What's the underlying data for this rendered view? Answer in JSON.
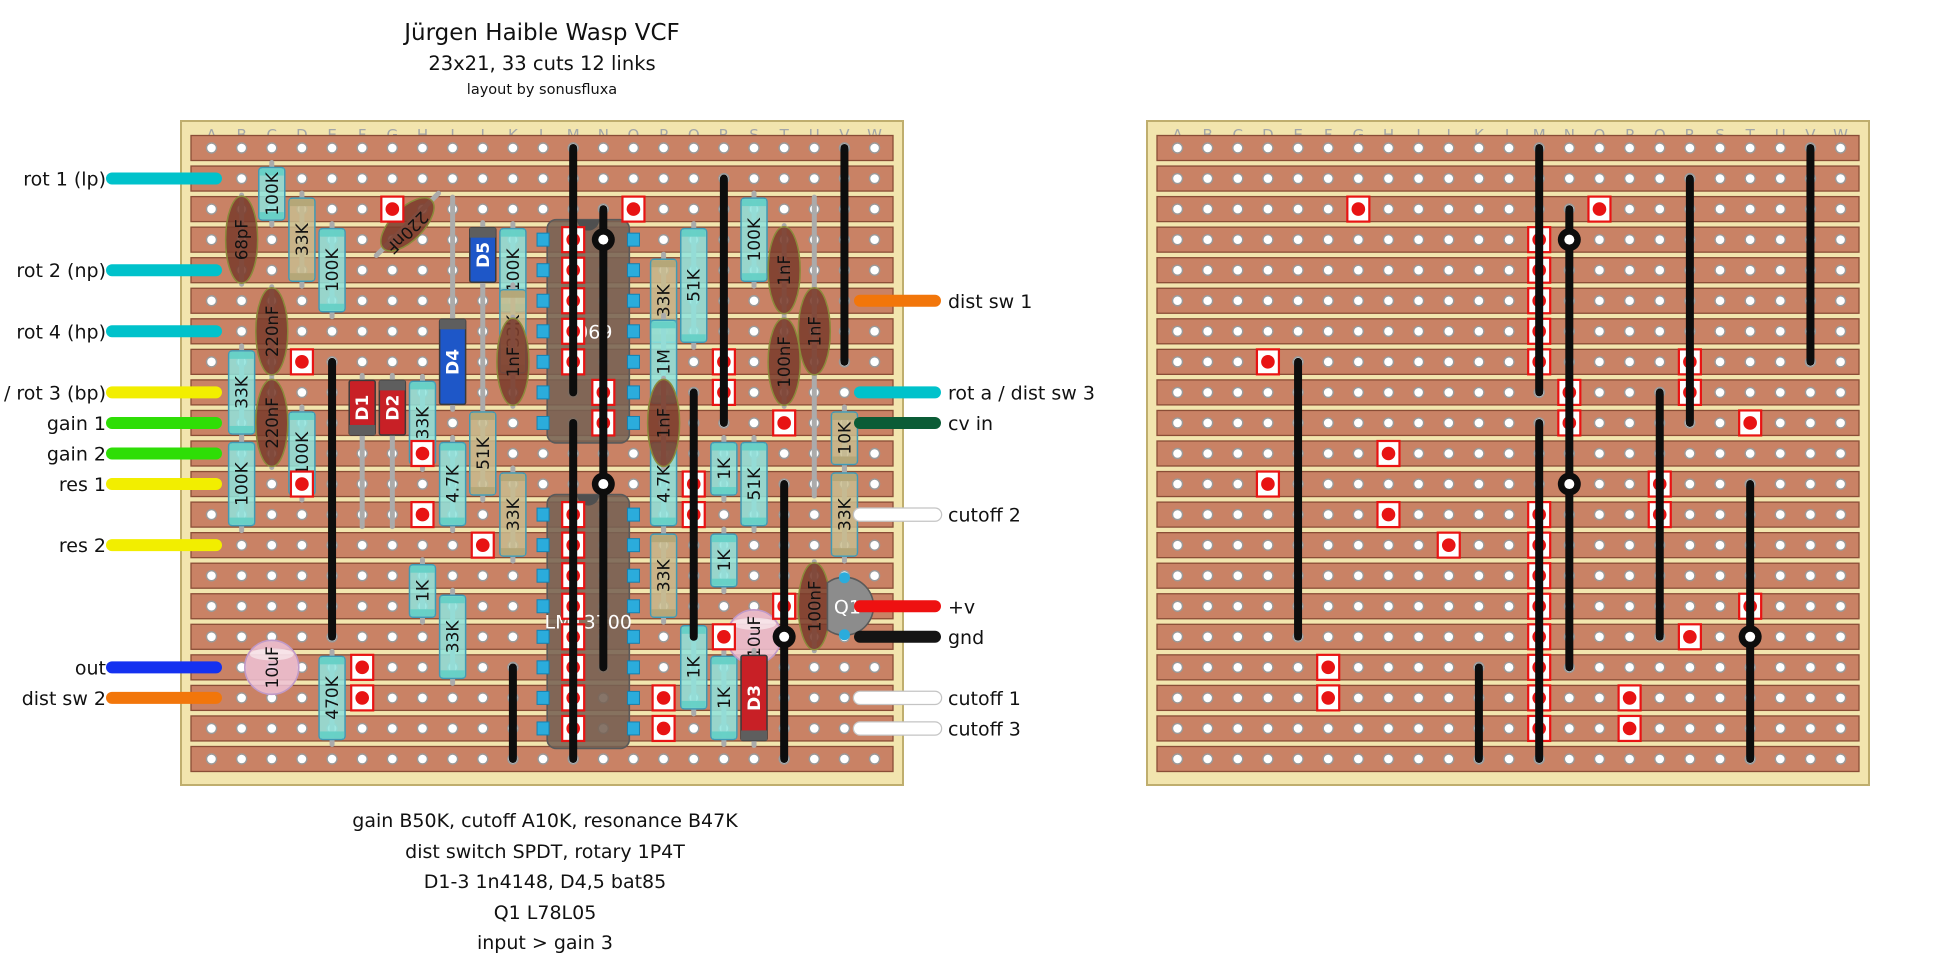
{
  "title": {
    "main": "Jürgen Haible Wasp VCF",
    "sub": "23x21, 33 cuts 12 links",
    "credit": "layout by sonusfluxa"
  },
  "notes": [
    "gain B50K, cutoff A10K, resonance B47K",
    "dist switch SPDT, rotary 1P4T",
    "D1-3 1n4148, D4,5 bat85",
    "Q1 L78L05",
    "input > gain 3"
  ],
  "grid": {
    "cols": "ABCDEFGHIJKLMNOPQRSTUVW",
    "rows": "ABCDEFGHIJKLMNOPQRSTU"
  },
  "cuts": [
    [
      "G",
      "C"
    ],
    [
      "O",
      "C"
    ],
    [
      "M",
      "D"
    ],
    [
      "M",
      "E"
    ],
    [
      "M",
      "F"
    ],
    [
      "M",
      "G"
    ],
    [
      "M",
      "H"
    ],
    [
      "D",
      "H"
    ],
    [
      "R",
      "H"
    ],
    [
      "N",
      "I"
    ],
    [
      "R",
      "I"
    ],
    [
      "N",
      "J"
    ],
    [
      "T",
      "J"
    ],
    [
      "H",
      "K"
    ],
    [
      "D",
      "L"
    ],
    [
      "Q",
      "L"
    ],
    [
      "H",
      "M"
    ],
    [
      "M",
      "M"
    ],
    [
      "Q",
      "M"
    ],
    [
      "J",
      "N"
    ],
    [
      "M",
      "N"
    ],
    [
      "M",
      "O"
    ],
    [
      "M",
      "P"
    ],
    [
      "T",
      "P"
    ],
    [
      "M",
      "Q"
    ],
    [
      "R",
      "Q"
    ],
    [
      "F",
      "R"
    ],
    [
      "M",
      "R"
    ],
    [
      "F",
      "S"
    ],
    [
      "M",
      "S"
    ],
    [
      "P",
      "S"
    ],
    [
      "M",
      "T"
    ],
    [
      "P",
      "T"
    ]
  ],
  "links": [
    [
      "M",
      "A",
      "I"
    ],
    [
      "M",
      "J",
      "U"
    ],
    [
      "V",
      "A",
      "H"
    ],
    [
      "R",
      "B",
      "J"
    ],
    [
      "N",
      "C",
      "D"
    ],
    [
      "N",
      "D",
      "L"
    ],
    [
      "N",
      "L",
      "R"
    ],
    [
      "E",
      "H",
      "Q"
    ],
    [
      "Q",
      "I",
      "Q"
    ],
    [
      "T",
      "L",
      "Q"
    ],
    [
      "T",
      "Q",
      "U"
    ],
    [
      "K",
      "R",
      "U"
    ]
  ],
  "junctions": [
    [
      "N",
      "D"
    ],
    [
      "N",
      "L"
    ],
    [
      "T",
      "Q"
    ]
  ],
  "ics": [
    {
      "label": "4069",
      "row1": "D",
      "row2": "J"
    },
    {
      "label": "LM13700",
      "row1": "M",
      "row2": "T"
    }
  ],
  "transistor": {
    "label": "Q1",
    "col": "V",
    "row1": "O",
    "row2": "Q"
  },
  "resistors": [
    {
      "label": "100K",
      "col": "C",
      "row1": "B",
      "row2": "C",
      "style": "cyan"
    },
    {
      "label": "33K",
      "col": "D",
      "row1": "C",
      "row2": "E",
      "style": "tan"
    },
    {
      "label": "100K",
      "col": "E",
      "row1": "D",
      "row2": "F",
      "style": "cyan"
    },
    {
      "label": "100K",
      "col": "K",
      "row1": "D",
      "row2": "F",
      "style": "cyan"
    },
    {
      "label": "100K",
      "col": "S",
      "row1": "C",
      "row2": "E",
      "style": "cyan"
    },
    {
      "label": "51K",
      "col": "Q",
      "row1": "D",
      "row2": "G",
      "style": "cyan"
    },
    {
      "label": "33K",
      "col": "P",
      "row1": "E",
      "row2": "G",
      "style": "tan"
    },
    {
      "label": "33K",
      "col": "K",
      "row1": "F",
      "row2": "H",
      "style": "tan"
    },
    {
      "label": "1M",
      "col": "P",
      "row1": "G",
      "row2": "I",
      "style": "cyan"
    },
    {
      "label": "33K",
      "col": "B",
      "row1": "H",
      "row2": "J",
      "style": "cyan"
    },
    {
      "label": "33K",
      "col": "H",
      "row1": "I",
      "row2": "K",
      "style": "cyan"
    },
    {
      "label": "51K",
      "col": "J",
      "row1": "J",
      "row2": "L",
      "style": "tan"
    },
    {
      "label": "100K",
      "col": "D",
      "row1": "J",
      "row2": "L",
      "style": "cyan"
    },
    {
      "label": "10K",
      "col": "V",
      "row1": "J",
      "row2": "K",
      "style": "tan"
    },
    {
      "label": "100K",
      "col": "B",
      "row1": "K",
      "row2": "M",
      "style": "cyan"
    },
    {
      "label": "4.7K",
      "col": "I",
      "row1": "K",
      "row2": "M",
      "style": "cyan"
    },
    {
      "label": "1K",
      "col": "R",
      "row1": "K",
      "row2": "L",
      "style": "cyan"
    },
    {
      "label": "51K",
      "col": "S",
      "row1": "K",
      "row2": "M",
      "style": "cyan"
    },
    {
      "label": "4.7K",
      "col": "P",
      "row1": "K",
      "row2": "M",
      "style": "cyan"
    },
    {
      "label": "33K",
      "col": "K",
      "row1": "L",
      "row2": "N",
      "style": "tan"
    },
    {
      "label": "33K",
      "col": "V",
      "row1": "L",
      "row2": "N",
      "style": "tan"
    },
    {
      "label": "33K",
      "col": "P",
      "row1": "N",
      "row2": "P",
      "style": "tan"
    },
    {
      "label": "1K",
      "col": "R",
      "row1": "N",
      "row2": "O",
      "style": "cyan"
    },
    {
      "label": "1K",
      "col": "H",
      "row1": "O",
      "row2": "P",
      "style": "cyan"
    },
    {
      "label": "33K",
      "col": "I",
      "row1": "P",
      "row2": "R",
      "style": "cyan"
    },
    {
      "label": "1K",
      "col": "Q",
      "row1": "Q",
      "row2": "S",
      "style": "cyan"
    },
    {
      "label": "470K",
      "col": "E",
      "row1": "R",
      "row2": "T",
      "style": "cyan"
    },
    {
      "label": "1K",
      "col": "R",
      "row1": "R",
      "row2": "T",
      "style": "cyan"
    }
  ],
  "capacitors": [
    {
      "label": "68pF",
      "col": "B",
      "row1": "C",
      "row2": "E"
    },
    {
      "label": "220nF",
      "col": "G",
      "row1": "C",
      "row2": "D",
      "diagonal": true
    },
    {
      "label": "220nF",
      "col": "C",
      "row1": "F",
      "row2": "H"
    },
    {
      "label": "220nF",
      "col": "C",
      "row1": "I",
      "row2": "K"
    },
    {
      "label": "1nF",
      "col": "T",
      "row1": "D",
      "row2": "F"
    },
    {
      "label": "1nF",
      "col": "U",
      "row1": "F",
      "row2": "H"
    },
    {
      "label": "100nF",
      "col": "T",
      "row1": "G",
      "row2": "I"
    },
    {
      "label": "1nF",
      "col": "K",
      "row1": "G",
      "row2": "I"
    },
    {
      "label": "1nF",
      "col": "P",
      "row1": "I",
      "row2": "K"
    },
    {
      "label": "100nF",
      "col": "U",
      "row1": "O",
      "row2": "Q"
    }
  ],
  "electrolytics": [
    {
      "label": "10uF",
      "col": "C",
      "row1": "Q",
      "row2": "S"
    },
    {
      "label": "10uF",
      "col": "S",
      "row1": "P",
      "row2": "R"
    }
  ],
  "diodes": [
    {
      "label": "D5",
      "col": "J",
      "row1": "D",
      "row2": "E",
      "color": "blue",
      "band": "top"
    },
    {
      "label": "D4",
      "col": "I",
      "row1": "G",
      "row2": "I",
      "color": "blue",
      "band": "top"
    },
    {
      "label": "D1",
      "col": "F",
      "row1": "I",
      "row2": "J",
      "color": "red",
      "band": "bottom"
    },
    {
      "label": "D2",
      "col": "G",
      "row1": "I",
      "row2": "J",
      "color": "red",
      "band": "top"
    },
    {
      "label": "D3",
      "col": "S",
      "row1": "R",
      "row2": "T",
      "color": "red",
      "band": "bottom"
    }
  ],
  "wires_left": [
    {
      "label": "rot 1 (lp)",
      "row": "B",
      "color": "#00c2cb"
    },
    {
      "label": "rot 2 (np)",
      "row": "E",
      "color": "#00c2cb"
    },
    {
      "label": "rot 4 (hp)",
      "row": "G",
      "color": "#00c2cb"
    },
    {
      "label": "res 3 / rot 3 (bp)",
      "row": "I",
      "color": "#f2ee00"
    },
    {
      "label": "gain 1",
      "row": "J",
      "color": "#2ede06"
    },
    {
      "label": "gain 2",
      "row": "K",
      "color": "#2ede06"
    },
    {
      "label": "res 1",
      "row": "L",
      "color": "#f2ee00"
    },
    {
      "label": "res 2",
      "row": "N",
      "color": "#f2ee00"
    },
    {
      "label": "out",
      "row": "R",
      "color": "#1431f0"
    },
    {
      "label": "dist sw 2",
      "row": "S",
      "color": "#f2760a"
    }
  ],
  "wires_right": [
    {
      "label": "dist sw 1",
      "row": "F",
      "color": "#f2760a"
    },
    {
      "label": "rot a / dist sw 3",
      "row": "I",
      "color": "#00c2cb"
    },
    {
      "label": "cv in",
      "row": "J",
      "color": "#0b5c36"
    },
    {
      "label": "cutoff 2",
      "row": "M",
      "color": "#ffffff"
    },
    {
      "label": "+v",
      "row": "P",
      "color": "#ee1111"
    },
    {
      "label": "gnd",
      "row": "Q",
      "color": "#141414"
    },
    {
      "label": "cutoff 1",
      "row": "S",
      "color": "#ffffff"
    },
    {
      "label": "cutoff 3",
      "row": "T",
      "color": "#ffffff"
    }
  ],
  "extra_leads": [
    [
      "U",
      "C",
      "L"
    ],
    [
      "I",
      "C",
      "G"
    ],
    [
      "F",
      "J",
      "M"
    ],
    [
      "G",
      "J",
      "M"
    ],
    [
      "J",
      "E",
      "I"
    ]
  ],
  "colors": {
    "substrate": "#f2e5ae",
    "substrate_border": "#bfae6e",
    "strip": "#c98265",
    "strip_border": "#8a4d36",
    "hole": "#ffffff",
    "hole_ring": "#9a9a9a",
    "letter": "#a3a7a8",
    "cut_red": "#e81313",
    "link": "#0d0d0d",
    "lead": "#ababab",
    "res_cyan": "#8fe4dd",
    "res_cyan_band": "#63cfc5",
    "res_tan": "#c9bc8e",
    "res_tan_band": "#b2a577",
    "res_border": "#3f9ab5",
    "cap_brown": "#7b3c2c",
    "cap_border": "#8a8a3a",
    "elco_pink": "#eec2d6",
    "elco_border": "#c09ac8",
    "diode_red": "#c82026",
    "diode_blue": "#1e57c8",
    "diode_band": "#5e5e5e",
    "ic_body": "rgba(118,98,84,0.88)",
    "ic_border": "#5a5a5a",
    "pin_blue": "#2bacdc",
    "pin_border": "#1580b0",
    "q1_gray": "#8c8c8c",
    "text": "#111111"
  }
}
